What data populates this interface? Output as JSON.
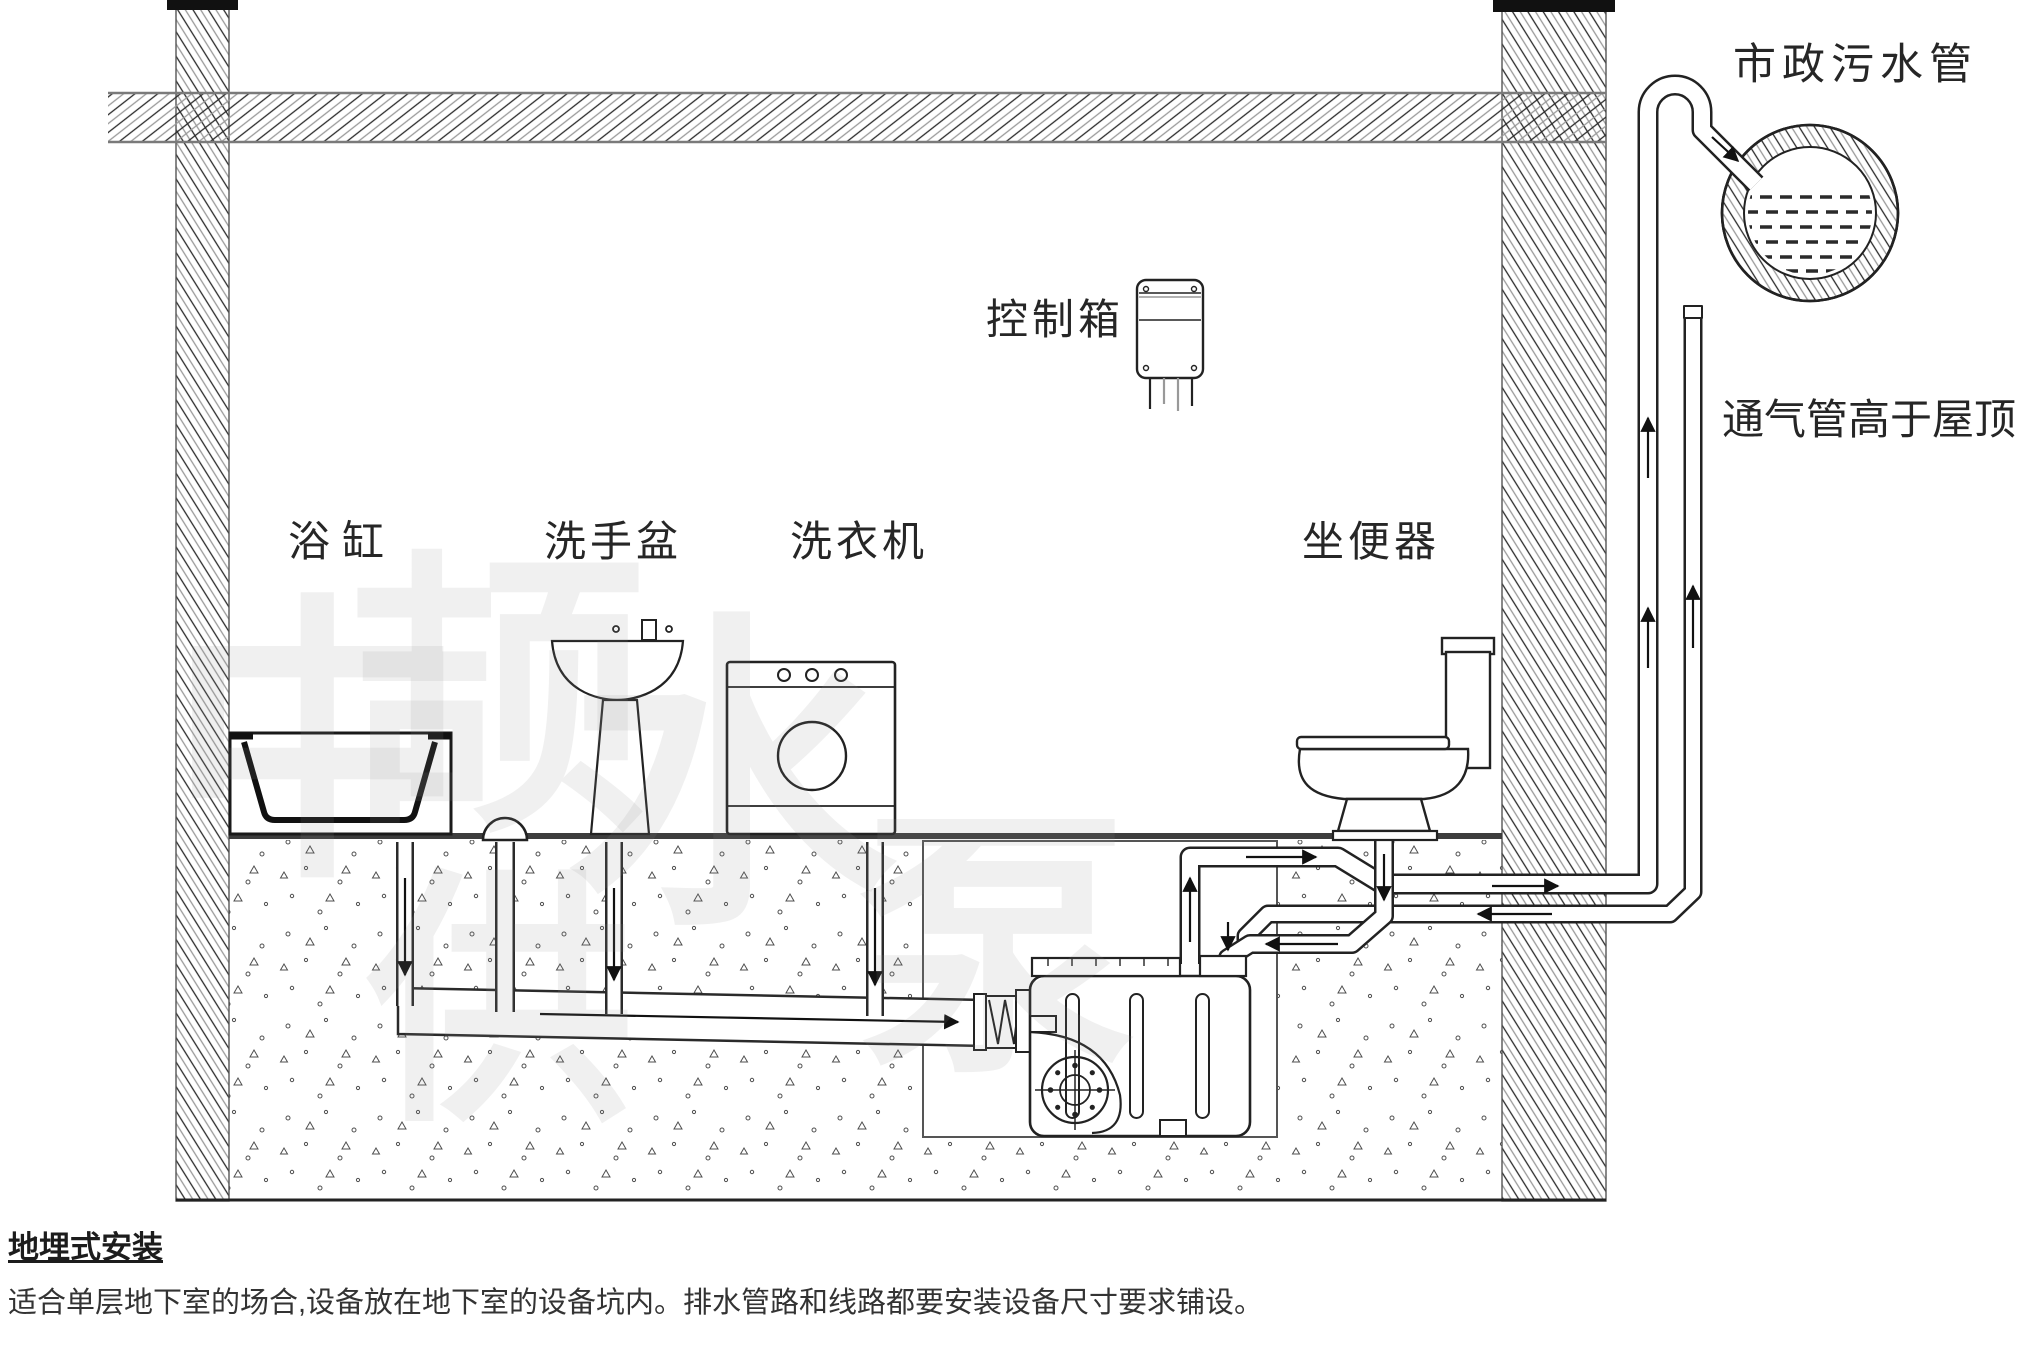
{
  "page": {
    "background": "#ffffff"
  },
  "colors": {
    "line": "#1f1f1f",
    "gray_line": "#8a8a8a",
    "floor": "#3d3d3d",
    "watermark": "#8f8f8f",
    "soil_speck": "#4f4f4f"
  },
  "diagram": {
    "labels": {
      "control_box": "控制箱",
      "bathtub": "浴缸",
      "wash_basin": "洗手盆",
      "washing_machine": "洗衣机",
      "toilet": "坐便器",
      "municipal_sewer": "市政污水管",
      "vent_pipe": "通气管高于屋顶"
    },
    "watermark_chars": [
      "中",
      "颉",
      "供",
      "水",
      "泵"
    ]
  },
  "caption": {
    "title": "地埋式安装",
    "body": "适合单层地下室的场合,设备放在地下室的设备坑内。排水管路和线路都要安装设备尺寸要求铺设。"
  }
}
